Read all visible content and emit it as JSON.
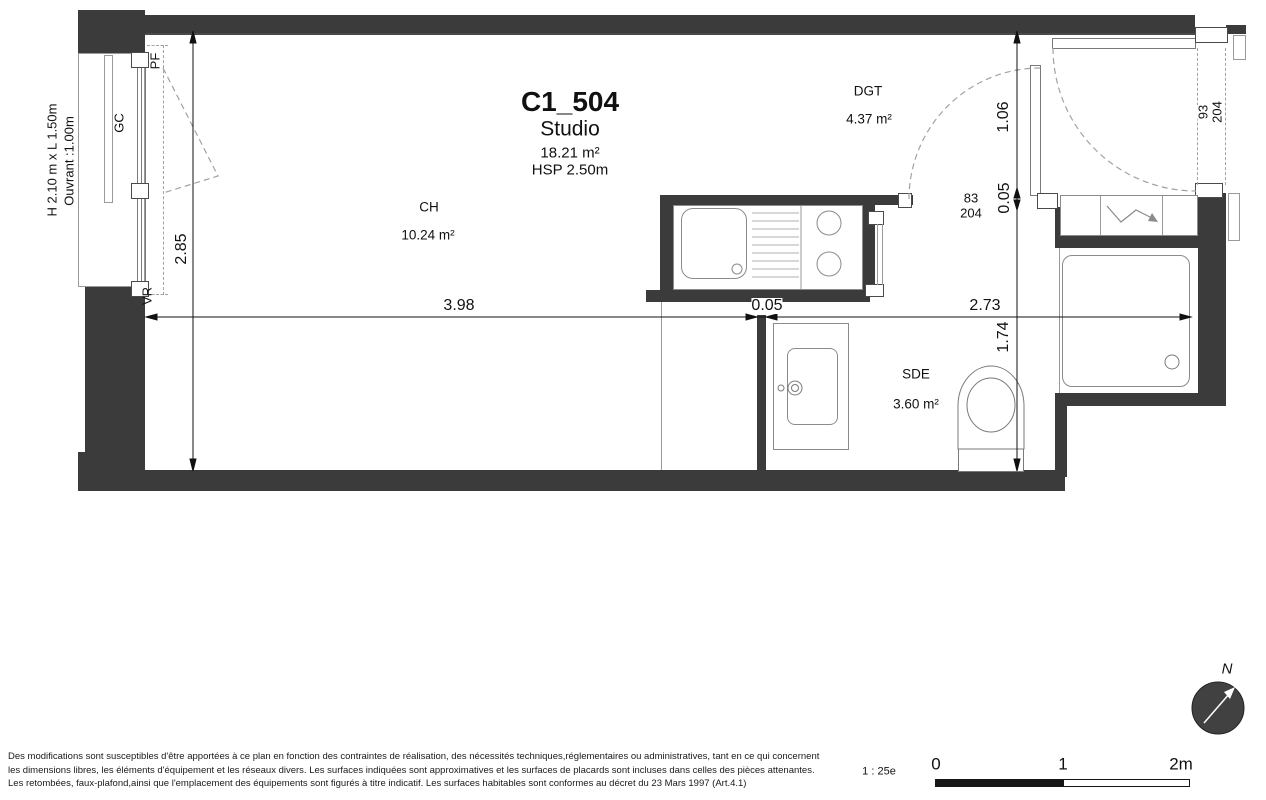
{
  "title": {
    "unit": "C1_504",
    "type": "Studio",
    "area": "18.21 m²",
    "hsp": "HSP 2.50m"
  },
  "rooms": {
    "ch": {
      "code": "CH",
      "area": "10.24 m²"
    },
    "dgt": {
      "code": "DGT",
      "area": "4.37 m²"
    },
    "sde": {
      "code": "SDE",
      "area": "3.60 m²"
    }
  },
  "window": {
    "size": "H 2.10 m x  L 1.50m",
    "opening": "Ouvrant :1.00m",
    "pf": "PF",
    "gc": "GC",
    "vr": "VR"
  },
  "dims": {
    "h285": "2.85",
    "w398": "3.98",
    "t005_wall": "0.05",
    "w273": "2.73",
    "h106": "1.06",
    "t005_right": "0.05",
    "h174": "1.74"
  },
  "doors": {
    "interior": {
      "w": "83",
      "h": "204"
    },
    "entrance": {
      "w": "93",
      "h": "204"
    }
  },
  "compass": {
    "north": "N"
  },
  "scalebar": {
    "ratio": "1 : 25e",
    "t0": "0",
    "t1": "1",
    "t2": "2m"
  },
  "disclaimer": {
    "l1": "Des modifications sont susceptibles d'être apportées à ce plan en fonction des contraintes de réalisation, des nécessités techniques,réglementaires ou administratives, tant en ce qui concernent",
    "l2": "les dimensions libres, les éléments d'équipement et les réseaux divers. Les surfaces indiquées sont approximatives et les surfaces de placards sont incluses dans celles des pièces attenantes.",
    "l3": "Les retombées, faux-plafond,ainsi que l'emplacement des équipements sont figurés à titre indicatif. Les surfaces habitables sont conformes au décret du 23 Mars 1997 (Art.4.1)"
  },
  "colors": {
    "wall": "#3b3b3b",
    "dim_line": "#111111",
    "fixture_line": "#8b8b8b"
  }
}
